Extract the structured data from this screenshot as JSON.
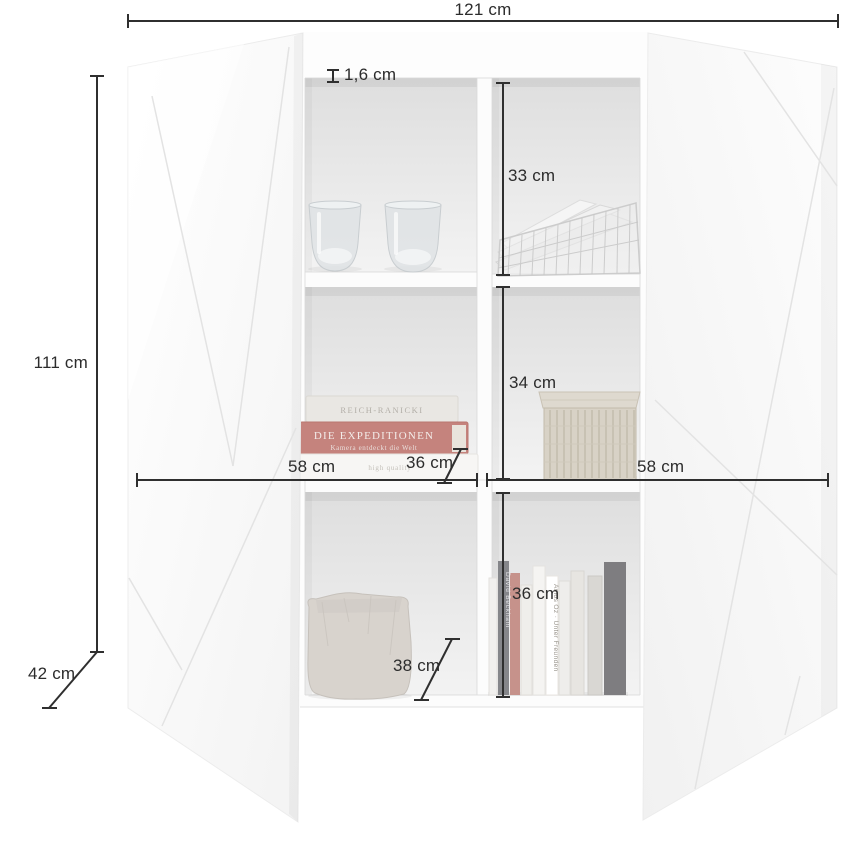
{
  "diagram": {
    "kind": "furniture-dimension-diagram",
    "subject": "two-door highboard with six open compartments"
  },
  "labels": {
    "width_total": "121 cm",
    "height_total": "111 cm",
    "depth_total": "42 cm",
    "shelf_thickness": "1,6 cm",
    "compartment_top_right_height": "33 cm",
    "compartment_middle_right_height": "34 cm",
    "compartment_bottom_right_height": "36 cm",
    "compartment_left_width": "58 cm",
    "compartment_inner_depth": "36 cm",
    "compartment_right_width": "58 cm",
    "compartment_bottom_depth": "38 cm"
  },
  "props": {
    "book_stack": {
      "top_spine": "REICH-RANICKI",
      "red_spine_line1": "DIE EXPEDITIONEN",
      "red_spine_line2": "Kamera entdeckt die Welt",
      "bottom_spine": "high quality"
    },
    "standing_books": {
      "spine_beckham": "David Beckham",
      "spine_amos": "Amos Oz · Unter Freunden"
    }
  },
  "colors": {
    "dimension_line": "#2f2f2f",
    "label_text": "#2c2c2c",
    "door_white": "#fafafa",
    "interior_grey": "#e2e2e2",
    "red_book": "#c5837d"
  }
}
